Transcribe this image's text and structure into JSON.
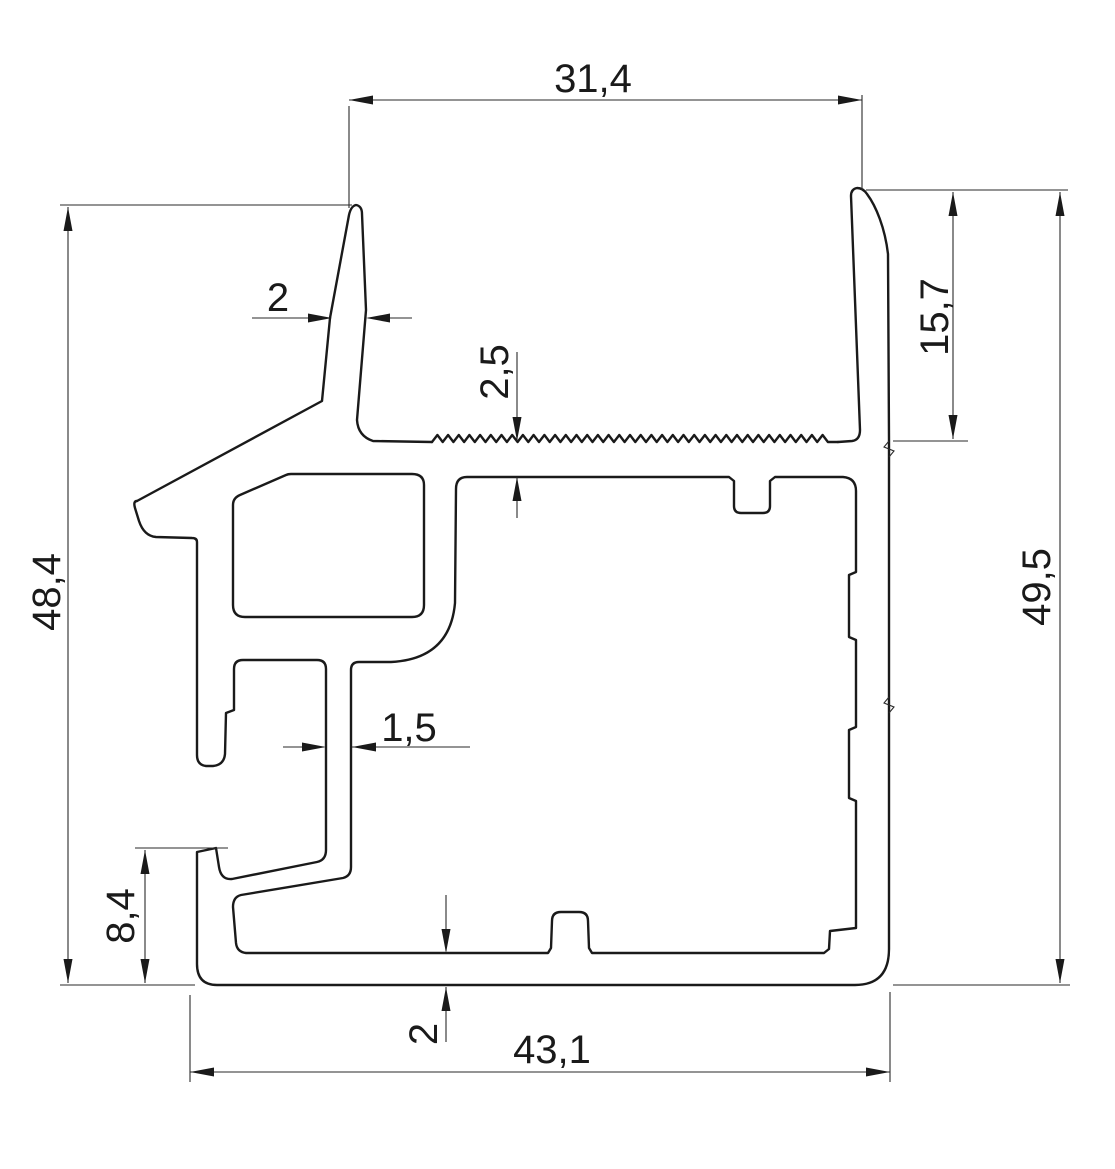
{
  "drawing": {
    "kind": "aluminium-profile-cross-section",
    "units": "mm",
    "background_color": "#ffffff",
    "line_color": "#1a1a1a",
    "dimensions": {
      "top_width": "31,4",
      "left_fin_thickness": "2",
      "top_wall_thickness": "2,5",
      "right_fin_height": "15,7",
      "left_height": "48,4",
      "right_height": "49,5",
      "mid_wall_thickness": "1,5",
      "hook_height": "8,4",
      "bottom_wall_thickness": "2",
      "bottom_width": "43,1"
    },
    "profile": {
      "outer_left_path": "M 137,501 L 322,401 L 330,318 L 349,215 Q 351,206 356,205 Q 362,206 362,214 L 366,310 L 357,420 Q 358,436 373,441 L 432,442",
      "outer_main_path": "M 838,442 L 852,441 Q 860,440 860,430 L 851,196 Q 851,189 857,188 Q 863,188 867,194 C 876,206 885,228 888,254 L 889,440 L 889,949 Q 889,985 855,985 L 217,985 Q 197,985 197,964 L 197,852 L 216,848 L 219,867 Q 221,880 232,879 L 317,862 Q 326,860 326,850 L 326,669 Q 326,660 317,660 L 243,660 Q 234,660 234,669 L 234,710 L 226,713 L 225,754 Q 224,765 213,766 L 206,766 Q 197,765 197,755 L 197,542 Q 197,538 192,538 L 156,537 Q 144,536 139,521 L 135,508 Q 133,501 137,501",
      "screw_channel_path": "M 291,474 L 412,474 Q 424,474 424,485 L 424,605 Q 424,617 412,617 L 245,617 Q 233,617 233,605 L 233,505 Q 233,498 240,495 L 286,475 Q 288,474 291,474 Z",
      "main_cavity_path": "M 467,477 L 729,477 L 734,481 L 734,506 Q 734,513 741,513 L 763,513 Q 770,513 770,506 L 770,481 L 775,477 L 843,477 Q 856,478 856,491 L 856,572 L 849,575 L 849,637 L 856,640 L 856,727 L 849,730 L 849,798 L 856,801 L 856,928 L 830,931 L 829,949 L 824,953 L 592,953 L 589,948 L 588,921 Q 588,912 579,912 L 561,912 Q 552,912 552,921 L 551,948 L 548,953 L 246,953 Q 237,952 236,943 L 233,907 Q 233,897 241,895 L 343,878 Q 351,876 351,867 L 351,670 Q 351,662 359,662 L 391,662 Q 450,659 455,603 L 456,489 Q 456,477 467,477 Z",
      "break_marks_path": "M 889,441 L 884,447 L 894,451 L 889,457 M 889,697 L 884,703 L 894,707 L 889,713",
      "serration": {
        "x_start": 432,
        "x_end": 838,
        "y": 442,
        "pitch": 10.7,
        "depth": 7
      }
    }
  }
}
